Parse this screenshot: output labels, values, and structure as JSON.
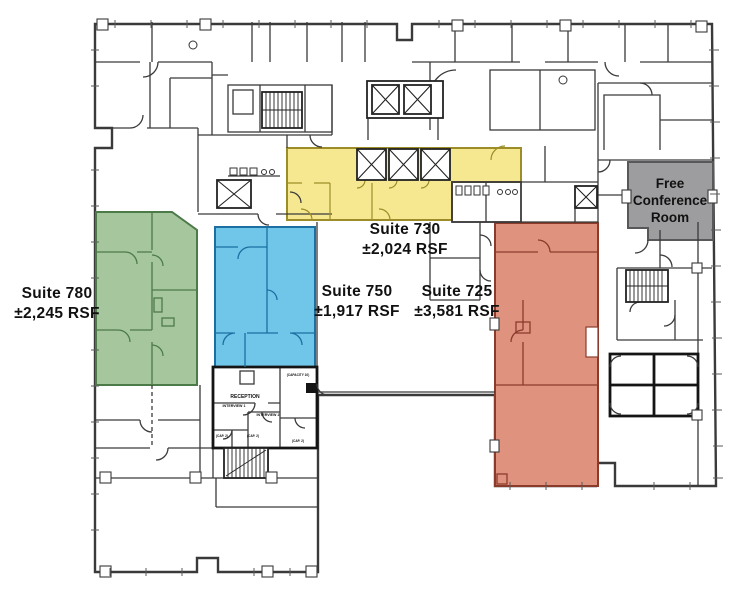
{
  "suites": [
    {
      "id": "780",
      "name": "Suite 780",
      "rsf": "±2,245 RSF",
      "fill": "#a6c79e",
      "stroke": "#4d7a49"
    },
    {
      "id": "750",
      "name": "Suite 750",
      "rsf": "±1,917 RSF",
      "fill": "#70c6e9",
      "stroke": "#1b6fa1"
    },
    {
      "id": "730",
      "name": "Suite 730",
      "rsf": "±2,024 RSF",
      "fill": "#f5e890",
      "stroke": "#9d8d28"
    },
    {
      "id": "725",
      "name": "Suite 725",
      "rsf": "±3,581 RSF",
      "fill": "#df937f",
      "stroke": "#8c3b2b"
    }
  ],
  "conference_room": {
    "lines": [
      "Free",
      "Conference",
      "Room"
    ],
    "fill": "#9d9da0",
    "stroke": "#58585a"
  },
  "plan_labels": {
    "reception": "RECEPTION",
    "interview1": "INTERVIEW 1",
    "interview2": "INTERVIEW 2",
    "capacity10": "(CAPACITY 10)",
    "cap2": "(CAP. 2)"
  },
  "icons": [
    "stairs-icon",
    "elevator-icon",
    "restroom-fixtures-icon"
  ]
}
